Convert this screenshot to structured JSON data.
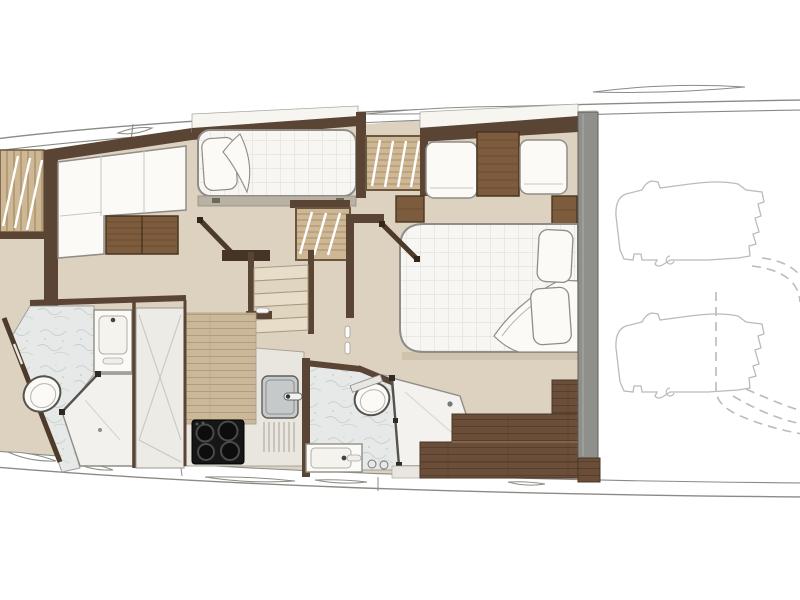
{
  "plan": {
    "type": "yacht-lower-deck-floor-plan",
    "areas": [
      "bow-storage",
      "forward-dinette",
      "guest-cabin",
      "staircase",
      "galley",
      "forward-bathroom",
      "hall-closet",
      "mid-bathroom",
      "master-cabin",
      "master-wardrobe",
      "tender-garage-outlines"
    ],
    "fixtures": [
      "single-berth",
      "double-berth",
      "l-sofa",
      "dinette-table",
      "wardrobe",
      "stairs",
      "cooktop",
      "sink",
      "toilet",
      "vanity",
      "shower",
      "nightstand",
      "sofa-seat",
      "jet-tender-outline",
      "garage-door-swing-arc"
    ]
  },
  "colors": {
    "page": "#ffffff",
    "band": "#ffffff",
    "hull_line": "#8b8b85",
    "wall": "#5a4433",
    "wood": "#7d5c3e",
    "wood_dark": "#4a3420",
    "wood_grain": "#6b4c30",
    "floor": "#ddd2c0",
    "floor_shadow": "#cfc3ae",
    "plank_light": "#cbb89a",
    "plank_light_line": "#b19c7c",
    "plank_dark": "#6b4e39",
    "plank_dark_line": "#583e2b",
    "white_furniture": "#fbfaf7",
    "furniture_stroke": "#8f8d86",
    "quilt_bg": "#f7f6f2",
    "quilt_line": "#dcdad2",
    "marble": "#e6e9e7",
    "marble_line": "#c9d2cf",
    "counter": "#e9e6df",
    "closet": "#edebe6",
    "wardrobe_gray": "#8f8f8b",
    "slat_wood": "#cdb795",
    "slat_line": "#9b8259",
    "stair_step": "#e7ddc9",
    "cooktop": "#161616",
    "sink_steel": "#c5c9c9",
    "outline_gray": "#bbbbb8"
  }
}
